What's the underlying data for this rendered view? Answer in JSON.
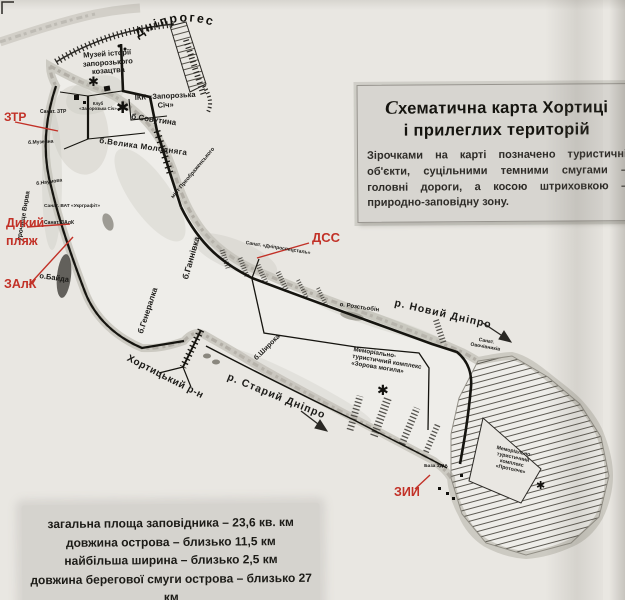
{
  "legend_box": {
    "title_initial": "С",
    "title_line1_rest": "хематична карта Хортиці",
    "title_line2": "і прилеглих територій",
    "body": "Зірочками на карті позначено туристичні об'єкти, суцільними темними смугами – головні дороги, а косою штриховкою – природно-заповідну зону."
  },
  "stats_box": {
    "line1": "загальна площа заповідника – 23,6 кв. км",
    "line2": "довжина острова – близько 11,5 км",
    "line3": "найбільша ширина – близько 2,5 км",
    "line4": "довжина берегової смуги острова – близько 27 км"
  },
  "red_labels": {
    "ztr": "ЗТР",
    "dykyi_pliazh": "Дикий пляж",
    "zalk": "ЗАлК",
    "dss": "ДСС",
    "zyy": "ЗИИ"
  },
  "map_labels": {
    "dniproges": "Дніпрогес",
    "museum": "Музей історії запорозького козацтва",
    "ikk": "ІКК «Запорозька Січ»",
    "klub": "Клуб «Запорозька Січ»",
    "sovutyna": "б.Совутина",
    "molodniaha": "б.Велика Молодняга",
    "mist": "міст Преображенського",
    "vyrva": "урочище Вирва",
    "muzeina": "б.Музейна",
    "sanat_ztr": "Санат. ЗТР",
    "naumova": "б.Наумова",
    "ukrgrafit": "Санат. ВАТ «Укрграфіт»",
    "sanat_zalk": "Санат. ЗАлК",
    "baida": "о.Байда",
    "hannivka": "б.Ганнівка",
    "heneralka": "б.Генералка",
    "dniprospetsstal": "Санат. «Дніпроспецсталь»",
    "novyi_dnipro": "р. Новий Дніпро",
    "rozstobin": "о. Розстьобін",
    "shyroka": "б.Широка",
    "khortytskyi": "Хортицький р-н",
    "staryi_dnipro": "р. Старий Дніпро",
    "ovochivnykiv": "Санат. Овочівників",
    "baza_zdia": "База ЗДІА",
    "memorial_zorova": {
      "l1": "Меморіально-",
      "l2": "туристичний комплекс",
      "l3": "«Зорова могила»"
    },
    "memorial_protolche": {
      "l1": "Меморіально-",
      "l2": "туристичний",
      "l3": "комплекс",
      "l4": "«Протолче»"
    }
  },
  "markers": {
    "tourist_object": "✱"
  },
  "colors": {
    "red": "#c23127",
    "ink": "#1b1a17",
    "paper": "#e9e7e2",
    "box_bg": "#d7d5d0"
  }
}
